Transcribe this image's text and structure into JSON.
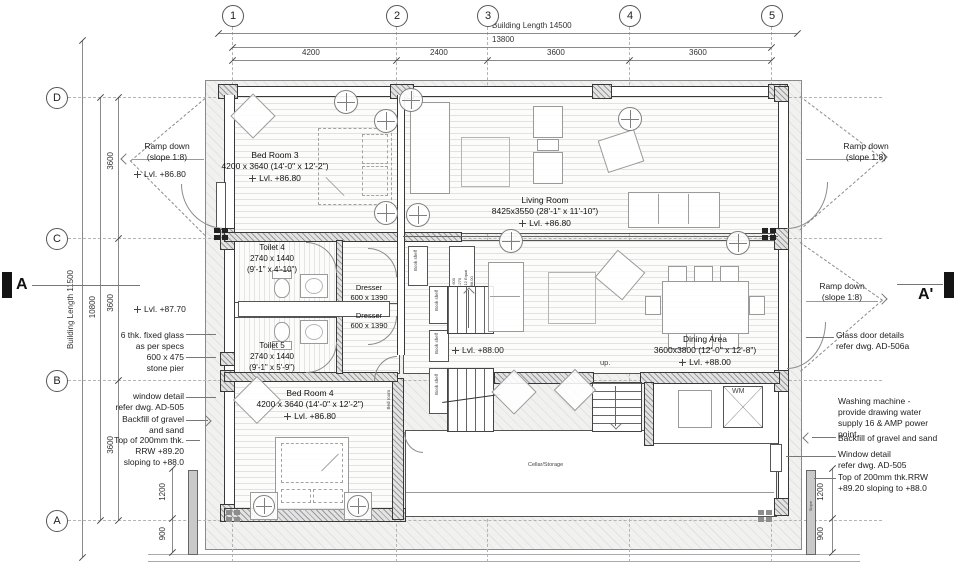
{
  "grid": {
    "cols": [
      "1",
      "2",
      "3",
      "4",
      "5"
    ],
    "rows": [
      "D",
      "C",
      "B",
      "A"
    ]
  },
  "dims": {
    "top_overall": "Building Length 14500",
    "top_sub": "13800",
    "top_segs": [
      "4200",
      "2400",
      "3600",
      "3600"
    ],
    "left_overall": "Building Length 11500",
    "left_sub": "10800",
    "left_segs": [
      "3600",
      "3600",
      "3600"
    ],
    "left_lower": [
      "1200",
      "900"
    ],
    "right_lower": [
      "1200",
      "900"
    ]
  },
  "sections": {
    "left": "A",
    "right": "A'"
  },
  "rooms": {
    "bedroom3": {
      "name": "Bed Room 3",
      "size": "4200 x 3640 (14'-0\" x 12'-2\")",
      "lvl": "Lvl. +86.80"
    },
    "living": {
      "name": "Living Room",
      "size": "8425x3550 (28'-1\" x 11'-10\")",
      "lvl": "Lvl. +86.80"
    },
    "toilet4": {
      "name": "Toilet 4",
      "size": "2740 x 1440",
      "size2": "(9'-1\" x 4'-10\")"
    },
    "toilet5": {
      "name": "Toilet 5",
      "size": "2740 x 1440",
      "size2": "(9'-1\" x 5'-9\")"
    },
    "dresser": {
      "name": "Dresser",
      "size": "600 x 1390"
    },
    "bedroom4": {
      "name": "Bed Room 4",
      "size": "4200 x 3640 (14'-0\" x 12'-2\")",
      "lvl": "Lvl. +86.80"
    },
    "dining": {
      "name": "Dining Area",
      "size": "3600x3800 (12'-0\" x 12'-8\")",
      "lvl": "Lvl. +88.00"
    },
    "hall_lvl": "Lvl. +88.00",
    "cellar": "Cellar/Storage",
    "wm": "WM",
    "up": "up.",
    "bookshelf": "Book shelf",
    "bedroom_door": "Bed room",
    "slope": "Slope",
    "stair_note": [
      "Width 600",
      "Tread 270",
      "Riser 12 Equal",
      "Lvl. +88.00"
    ]
  },
  "notes_left": {
    "ramp": [
      "Ramp down",
      "(slope 1:8)"
    ],
    "lvl_86": "Lvl. +86.80",
    "lvl_87": "Lvl. +87.70",
    "glass": [
      "6 thk. fixed glass",
      "as per specs"
    ],
    "pier": [
      "600 x 475",
      "stone pier"
    ],
    "window": [
      "window detail",
      "refer dwg. AD-505"
    ],
    "backfill": [
      "Backfill of gravel",
      "and sand"
    ],
    "rrw": [
      "Top of 200mm thk.",
      "RRW +89.20",
      "sloping to +88.0"
    ]
  },
  "notes_right": {
    "ramp_top": [
      "Ramp down",
      "(slope 1:8)"
    ],
    "ramp_mid": [
      "Ramp down",
      "(slope 1:8)"
    ],
    "glass_door": [
      "Glass door details",
      "refer dwg. AD-506a"
    ],
    "washing": [
      "Washing machine -",
      "provide drawing water",
      "supply 16 & AMP power",
      "point"
    ],
    "backfill": "Backfill of gravel and sand",
    "window": [
      "Window detail",
      "refer dwg. AD-505"
    ],
    "rrw": [
      "Top of 200mm thk.RRW",
      "+89.20 sloping to +88.0"
    ]
  }
}
